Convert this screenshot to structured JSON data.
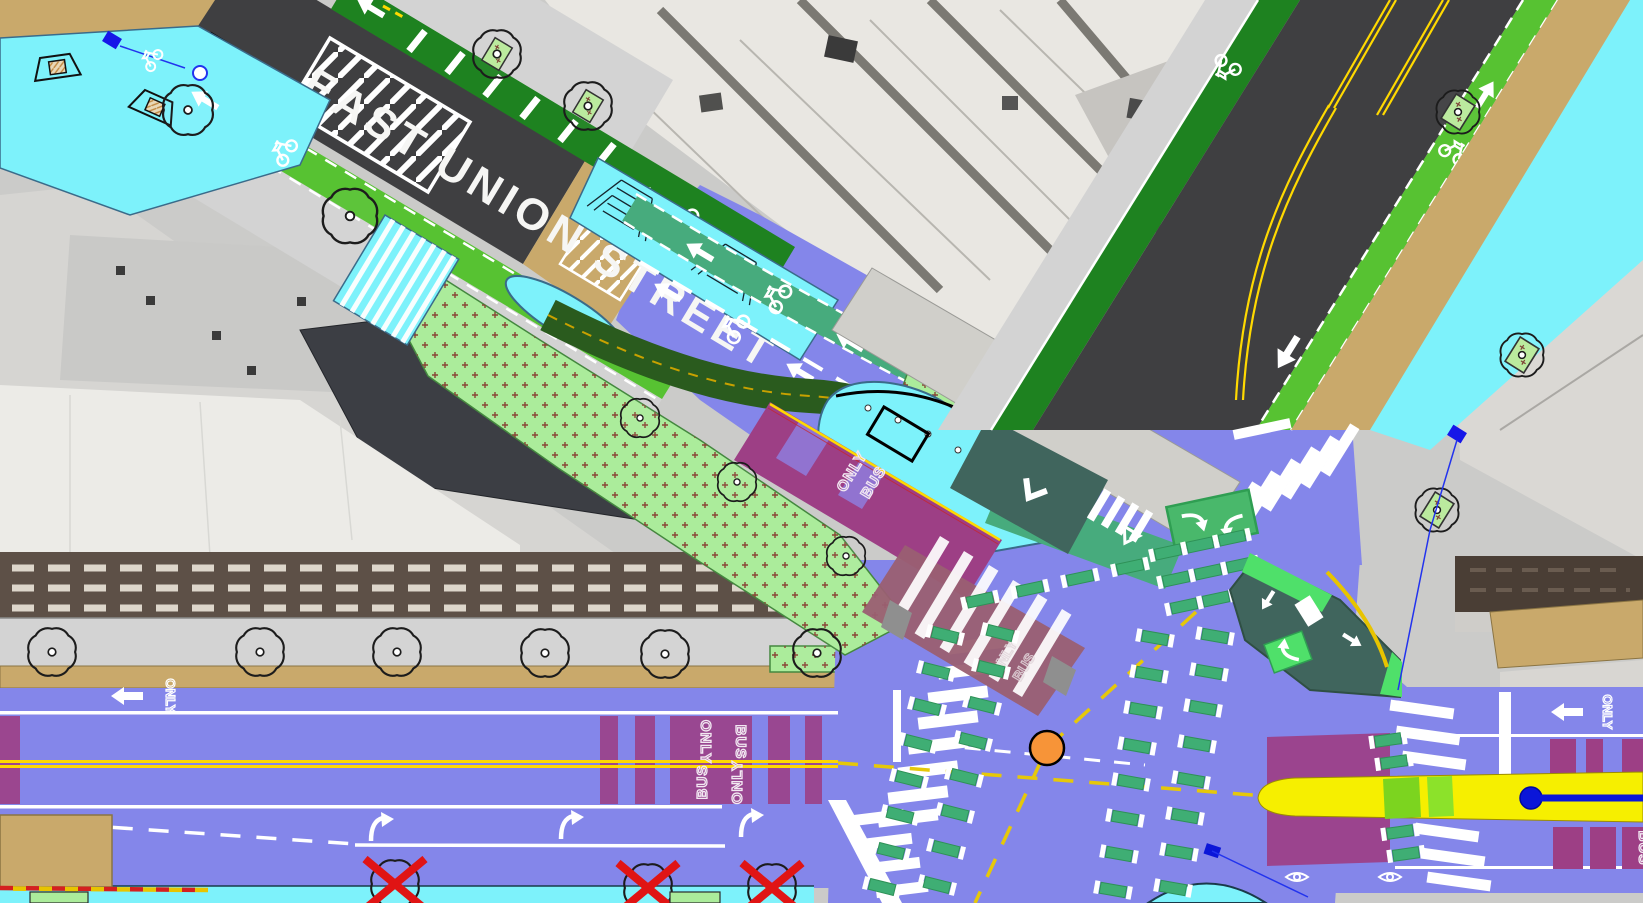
{
  "labels": {
    "parking": "PARKING",
    "street_name": "EAST UNION STREET",
    "bus": "BUS",
    "only": "ONLY"
  },
  "palette": {
    "proposed_roadway_purple": "#8486ea",
    "bus_only_lane_magenta": "#9d3f85",
    "bus_lane_faded_rose": "#9a5f72",
    "new_sidewalk_cyan": "#7df2fb",
    "existing_sidewalk_gray": "#d3d3d3",
    "existing_asphalt": "#3f3f41",
    "bike_lane_bright_green": "#57c232",
    "bike_lane_dark_green": "#1e8220",
    "protected_bike_lane_forest": "#2a5b1e",
    "protected_intersection_teal": "#40655d",
    "contraflow_lane_seagreen": "#47ab7d",
    "bike_crossing_dash_green": "#3fae74",
    "landscaping_pale_green": "#abec9b",
    "parking_strip_tan": "#c9a96b",
    "centerline_yellow": "#ffd900",
    "highlight_band_yellow": "#f6ef00",
    "signal_orange": "#f79438",
    "marker_blue": "#0b16d8",
    "tree_removal_red": "#e01414"
  },
  "icons": {
    "tree": "tree-icon",
    "tree_removal": "tree-removal-x-icon",
    "bike": "bike-symbol-icon",
    "straight_arrow": "straight-arrow-icon",
    "left_turn_arrow": "left-turn-arrow-icon",
    "right_turn_arrow": "right-turn-arrow-icon",
    "lane_chevron": "chevron-icon",
    "signal_head": "signal-eye-icon",
    "curb_ramp": "curb-ramp-icon",
    "stairs": "stairs-icon",
    "planter": "tree-planter-icon",
    "signal_dot": "intersection-signal-dot",
    "survey_marker": "blue-marker-icon"
  }
}
